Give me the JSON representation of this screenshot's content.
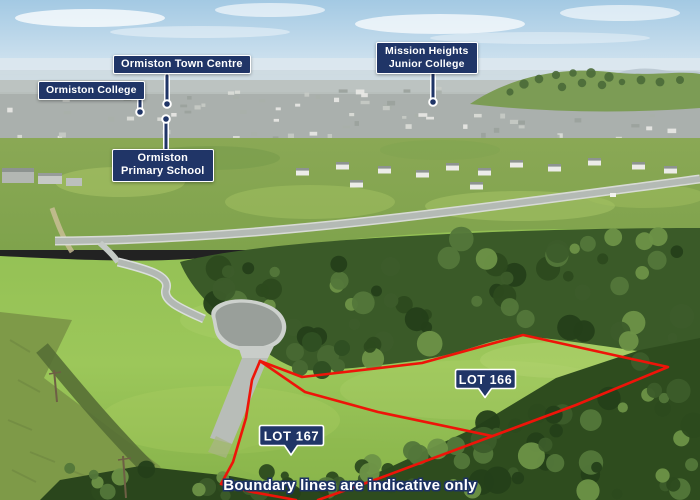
{
  "labels": {
    "town_centre": "Ormiston Town Centre",
    "college": "Ormiston College",
    "mission_heights_line1": "Mission Heights",
    "mission_heights_line2": "Junior College",
    "primary_line1": "Ormiston",
    "primary_line2": "Primary School",
    "lot166": "LOT 166",
    "lot167": "LOT 167",
    "disclaimer": "Boundary lines are indicative only"
  },
  "colors": {
    "label_navy": "#203567",
    "label_border": "#ffffff",
    "boundary_red": "#ee1409"
  },
  "markers": {
    "town_centre_dot": "location-dot",
    "college_dot": "location-dot",
    "mission_heights_dot": "location-dot",
    "primary_dot": "location-dot"
  }
}
